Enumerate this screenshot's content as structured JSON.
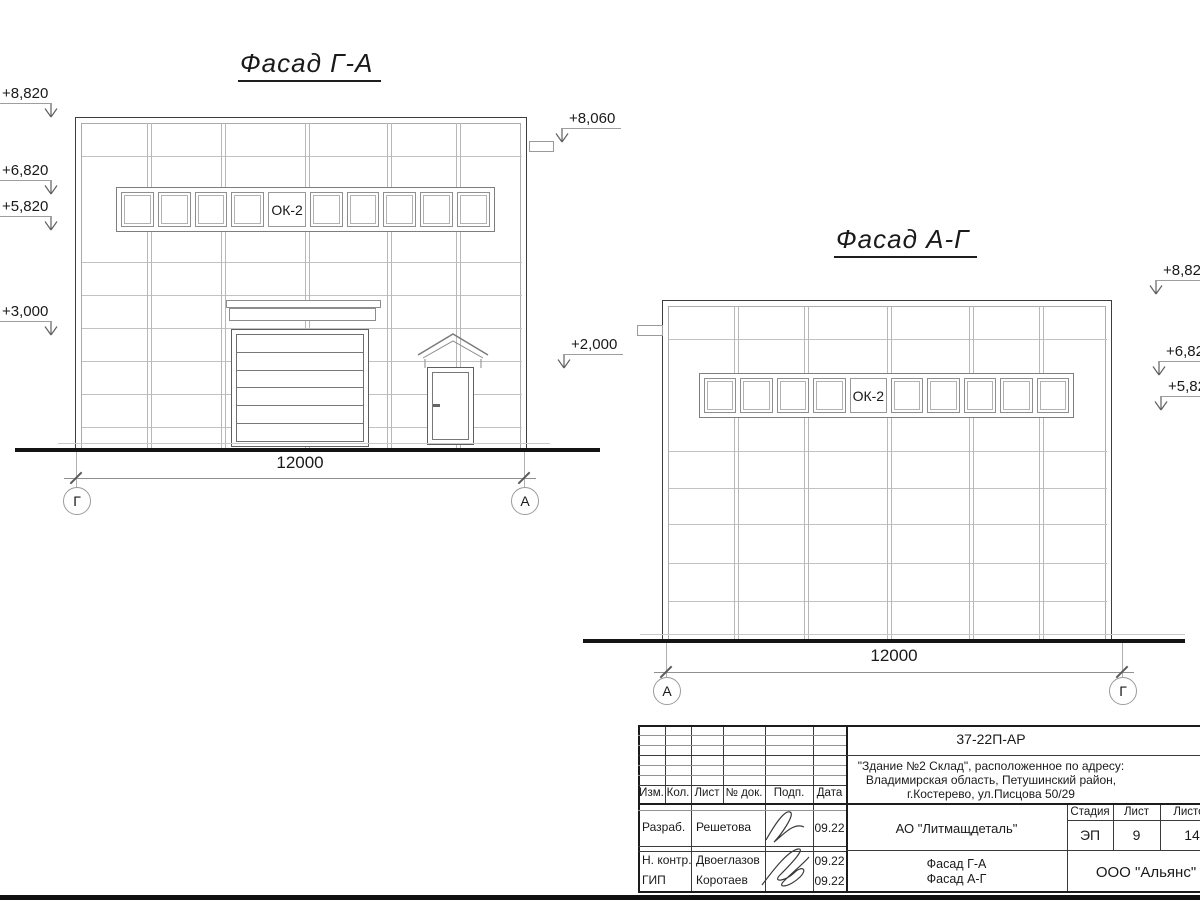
{
  "drawing": {
    "facade_ga": {
      "title": "Фасад Г-А",
      "window_label": "ОК-2",
      "dimension": "12000",
      "axis_left": "Г",
      "axis_right": "А",
      "elev_left": [
        "+8,820",
        "+6,820",
        "+5,820",
        "+3,000"
      ],
      "elev_right": [
        "+8,060",
        "+2,000"
      ]
    },
    "facade_ag": {
      "title": "Фасад А-Г",
      "window_label": "ОК-2",
      "dimension": "12000",
      "axis_left": "А",
      "axis_right": "Г",
      "elev_right": [
        "+8,820",
        "+6,820",
        "+5,820"
      ]
    }
  },
  "titleblock": {
    "designation": "37-22П-АР",
    "address_line1": "\"Здание №2 Склад\", расположенное по адресу:",
    "address_line2": "Владимирская область, Петушинский район,",
    "address_line3": "г.Костерево, ул.Писцова 50/29",
    "company": "АО \"Литмащдеталь\"",
    "org": "ООО \"Альянс\"",
    "sheet_title_line1": "Фасад Г-А",
    "sheet_title_line2": "Фасад А-Г",
    "headers": {
      "izm": "Изм.",
      "kol": "Кол.",
      "list": "Лист",
      "doc": "№ док.",
      "podp": "Подп.",
      "data": "Дата"
    },
    "stage_header": "Стадия",
    "sheet_header": "Лист",
    "sheets_header": "Листов",
    "stage": "ЭП",
    "sheet": "9",
    "sheets": "14",
    "rows": [
      {
        "role": "Разраб.",
        "name": "Решетова",
        "date": "09.22"
      },
      {
        "role": "Н. контр.",
        "name": "Двоеглазов",
        "date": "09.22"
      },
      {
        "role": "ГИП",
        "name": "Коротаев",
        "date": "09.22"
      }
    ]
  }
}
